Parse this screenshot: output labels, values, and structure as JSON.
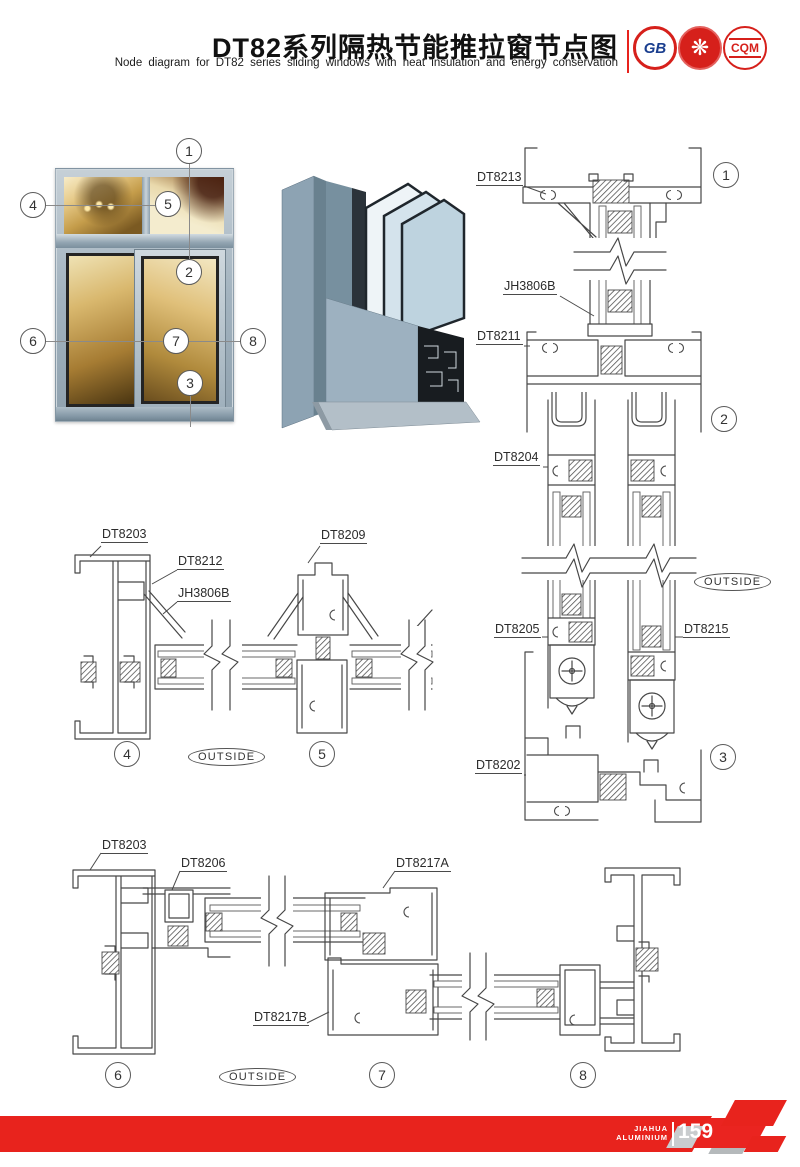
{
  "header": {
    "title": "DT82系列隔热节能推拉窗节点图",
    "subtitle": "Node diagram for DT82 series sliding windows with heat insulation and energy conservation",
    "logos": [
      {
        "name": "gb-cert-badge",
        "text": "GB"
      },
      {
        "name": "quality-seal-badge",
        "text": "❋"
      },
      {
        "name": "cqm-cert-badge",
        "text": "CQM"
      }
    ]
  },
  "overview": {
    "window_callouts": [
      "1",
      "2",
      "3",
      "4",
      "5",
      "6",
      "7",
      "8"
    ]
  },
  "sections": {
    "vertical": {
      "labels": {
        "l1": "DT8213",
        "l2": "JH3806B",
        "l3": "DT8211",
        "l4": "DT8204",
        "l5": "DT8205",
        "l6": "DT8215",
        "l7": "DT8202"
      },
      "callouts": {
        "c1": "1",
        "c2": "2",
        "c3": "3"
      },
      "outside": "OUTSIDE"
    },
    "horizontal_mid": {
      "labels": {
        "l1": "DT8203",
        "l2": "DT8212",
        "l3": "JH3806B",
        "l4": "DT8209"
      },
      "callouts": {
        "c4": "4",
        "c5": "5"
      },
      "outside": "OUTSIDE"
    },
    "horizontal_bottom": {
      "labels": {
        "l1": "DT8203",
        "l2": "DT8206",
        "l3": "DT8217A",
        "l4": "DT8217B"
      },
      "callouts": {
        "c6": "6",
        "c7": "7",
        "c8": "8"
      },
      "outside": "OUTSIDE"
    }
  },
  "footer": {
    "brand_line1": "JIAHUA",
    "brand_line2": "ALUMINIUM",
    "page_number": "159"
  },
  "colors": {
    "accent_red": "#E8231D",
    "line": "#4A4A4A"
  }
}
